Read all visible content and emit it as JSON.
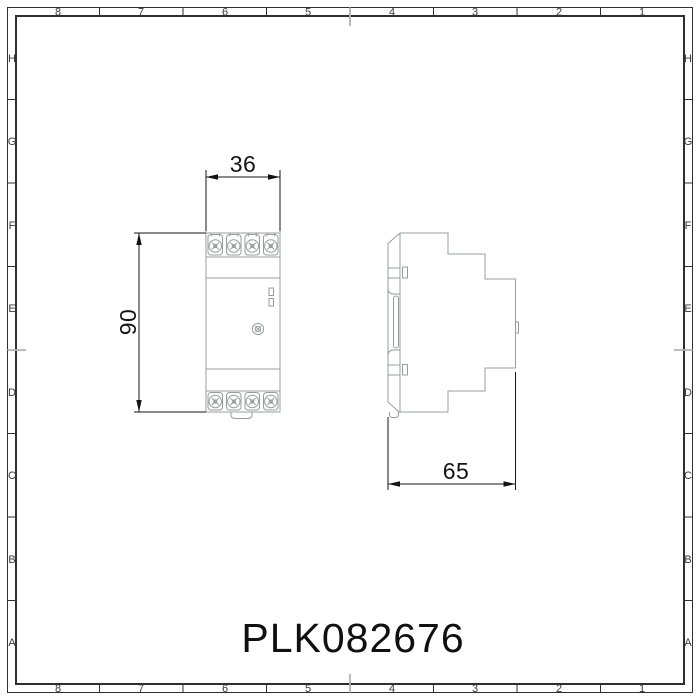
{
  "drawing": {
    "part_number": "PLK082676",
    "dimensions": {
      "width_mm": "36",
      "height_mm": "90",
      "depth_mm": "65"
    },
    "views": {
      "front": "front-view-din-module",
      "side": "side-profile-din-module"
    }
  },
  "frame": {
    "column_labels": [
      "8",
      "7",
      "6",
      "5",
      "4",
      "3",
      "2",
      "1"
    ],
    "row_labels": [
      "H",
      "G",
      "F",
      "E",
      "D",
      "C",
      "B",
      "A"
    ]
  },
  "colors": {
    "background": "#ffffff",
    "frame": "#2f2f2f",
    "frame_text": "#3a3a3a",
    "device_outline": "#989c9f",
    "dimension": "#141414",
    "center_mark": "#b2b2b2",
    "title_text": "#101010"
  }
}
